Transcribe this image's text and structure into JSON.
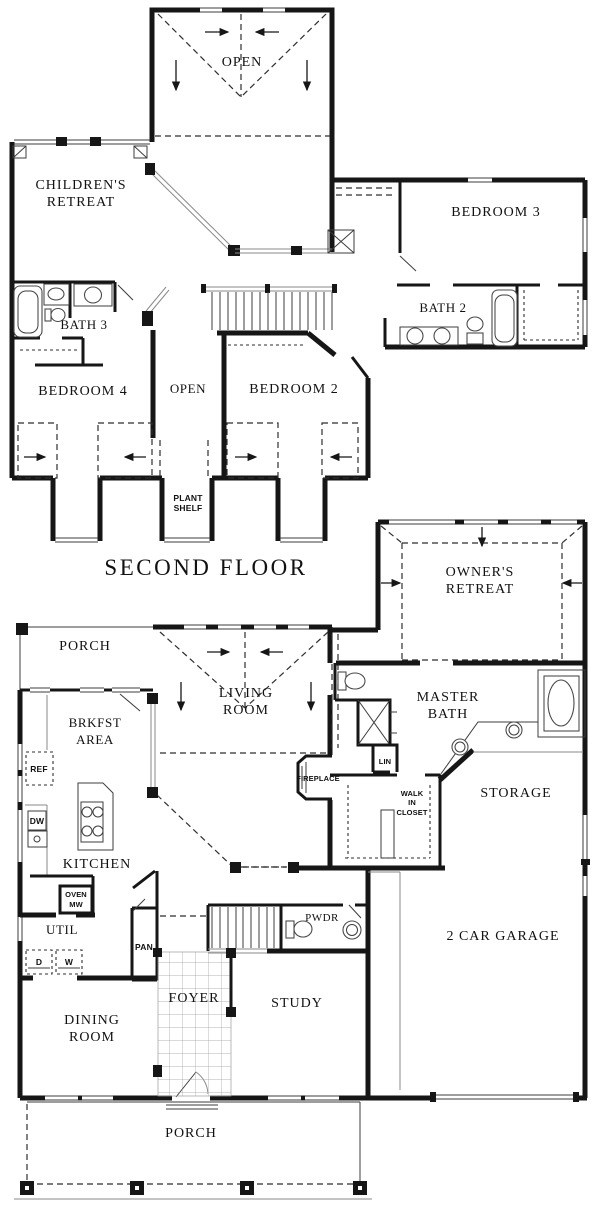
{
  "document": {
    "type": "house floor plan",
    "floor_title": "SECOND FLOOR"
  },
  "colors": {
    "wall": "#161616",
    "background": "#ffffff",
    "thin_line": "#8a8a8a"
  },
  "labels": {
    "open_upper": "OPEN",
    "childrens_1": "CHILDREN'S",
    "childrens_2": "RETREAT",
    "bedroom3": "BEDROOM 3",
    "bath3": "BATH 3",
    "bath2": "BATH 2",
    "bedroom4": "BEDROOM 4",
    "open_mid": "OPEN",
    "bedroom2": "BEDROOM 2",
    "plant_1": "PLANT",
    "plant_2": "SHELF",
    "second_floor": "SECOND FLOOR",
    "porch_top": "PORCH",
    "living_1": "LIVING",
    "living_2": "ROOM",
    "owners_1": "OWNER'S",
    "owners_2": "RETREAT",
    "master_1": "MASTER",
    "master_2": "BATH",
    "brkfst_1": "BRKFST",
    "brkfst_2": "AREA",
    "ref": "REF",
    "dw": "DW",
    "kitchen": "KITCHEN",
    "fireplace": "FIREPLACE",
    "lin": "LIN",
    "wic_1": "WALK",
    "wic_2": "IN",
    "wic_3": "CLOSET",
    "storage": "STORAGE",
    "garage": "2 CAR GARAGE",
    "oven": "OVEN",
    "mw": "MW",
    "util": "UTIL",
    "d": "D",
    "w": "W",
    "pan": "PAN",
    "pwdr": "PWDR",
    "foyer": "FOYER",
    "dining_1": "DINING",
    "dining_2": "ROOM",
    "study": "STUDY",
    "porch_bottom": "PORCH"
  }
}
